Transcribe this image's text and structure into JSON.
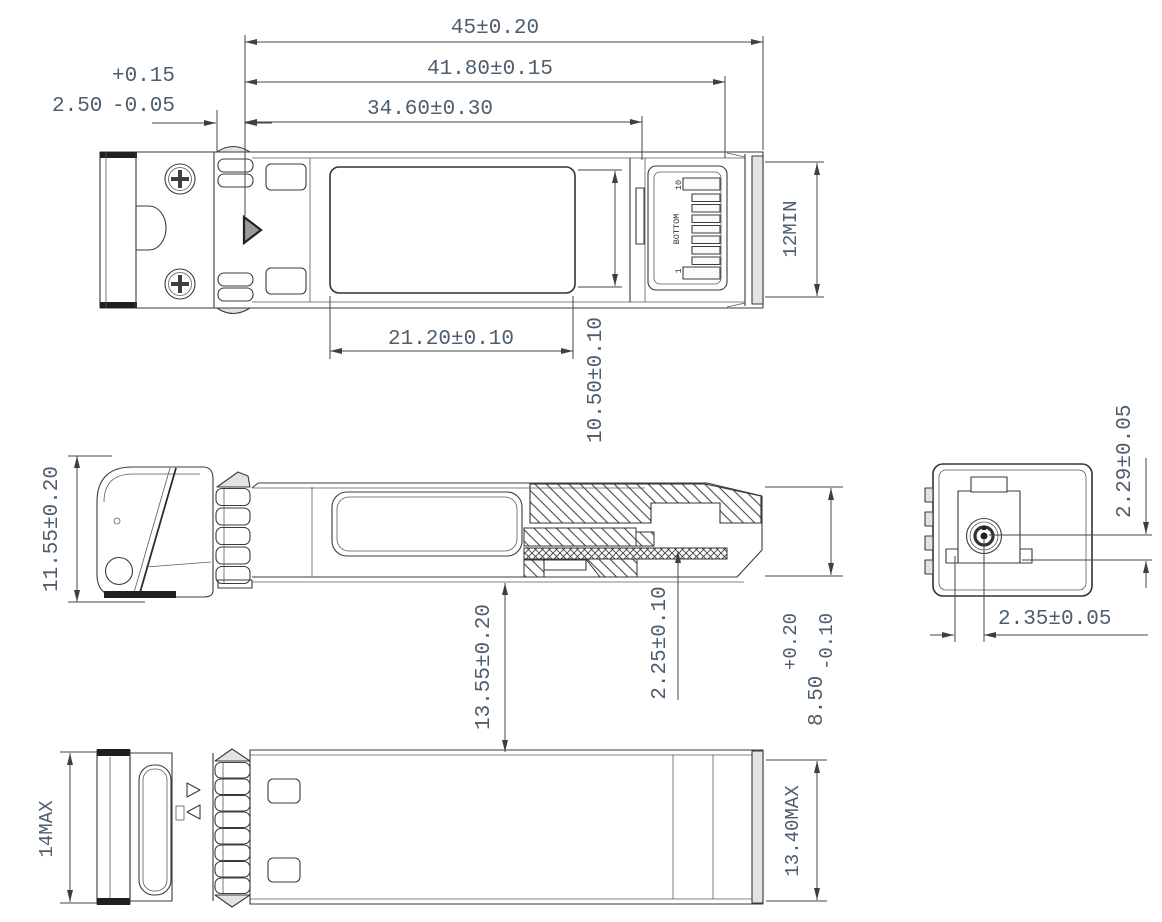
{
  "drawing_type": "mechanical-outline-drawing",
  "views": {
    "top": {
      "dim_overall": "45±0.20",
      "dim_body": "41.80±0.15",
      "dim_housing": "34.60±0.30",
      "dim_flange": {
        "value": "2.50",
        "plus": "+0.15",
        "minus": "-0.05"
      },
      "dim_label_width": "21.20±0.10",
      "dim_label_height": "10.50±0.10",
      "dim_width_min": "12MIN",
      "connector": {
        "pin_top": "10",
        "label": "BOTTOM",
        "pin_bottom": "1"
      }
    },
    "side": {
      "dim_latch_height": "11.55±0.20",
      "dim_13_55": "13.55±0.20",
      "dim_pcb": "2.25±0.10",
      "dim_height": {
        "value": "8.50",
        "plus": "+0.20",
        "minus": "-0.10"
      }
    },
    "bottom": {
      "dim_height_max": "14MAX",
      "dim_width_max": "13.40MAX"
    },
    "end": {
      "dim_ferrule_vertical": "2.29±0.05",
      "dim_ferrule_horizontal": "2.35±0.05"
    }
  },
  "colors": {
    "line": "#3b3b3b",
    "dim_text": "#4d5d6c",
    "background": "#ffffff",
    "fill_light_gray": "#e3e3e3",
    "fill_dark": "#1f1f1f"
  }
}
